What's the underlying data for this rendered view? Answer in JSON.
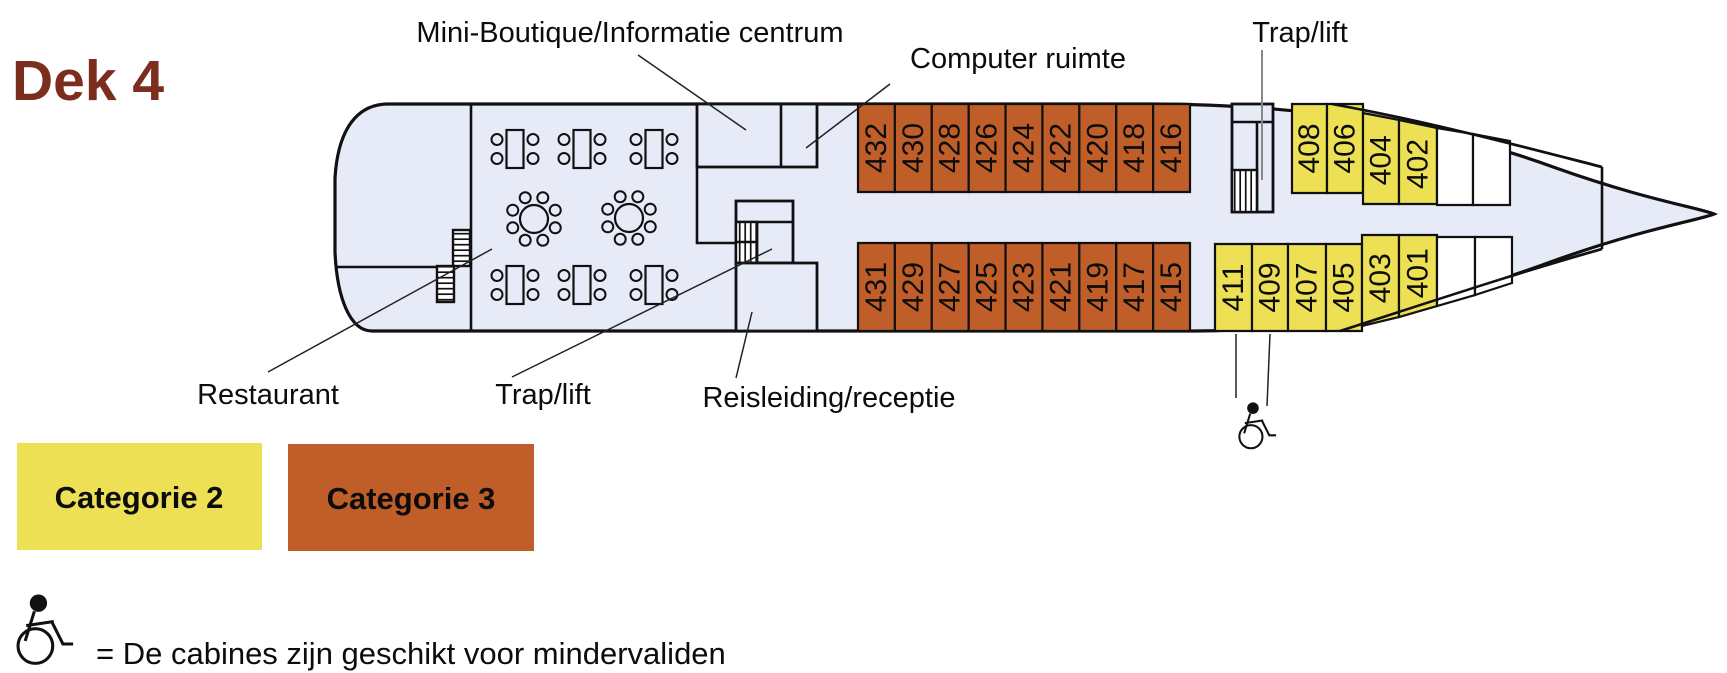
{
  "title": "Dek 4",
  "colors": {
    "category2_yellow": "#ede054",
    "category3_orange": "#c05e29",
    "deck_fill": "#e7ebf7",
    "hull_stroke": "#111111",
    "title_color": "#7b2d1e"
  },
  "plan_labels": {
    "mini_boutique": "Mini-Boutique/Informatie centrum",
    "computer_room": "Computer ruimte",
    "stairs_lift_top": "Trap/lift",
    "restaurant": "Restaurant",
    "stairs_lift_bottom": "Trap/lift",
    "reception": "Reisleiding/receptie"
  },
  "cabins": {
    "top_category3": [
      "432",
      "430",
      "428",
      "426",
      "424",
      "422",
      "420",
      "418",
      "416"
    ],
    "top_category2": [
      "408",
      "406",
      "404",
      "402"
    ],
    "bottom_category3": [
      "431",
      "429",
      "427",
      "425",
      "423",
      "421",
      "419",
      "417",
      "415"
    ],
    "bottom_category2": [
      "411",
      "409",
      "407",
      "405",
      "403",
      "401"
    ]
  },
  "legend": {
    "category2_label": "Categorie 2",
    "category3_label": "Categorie 3",
    "wheelchair_note": "= De cabines zijn geschikt voor mindervaliden"
  }
}
